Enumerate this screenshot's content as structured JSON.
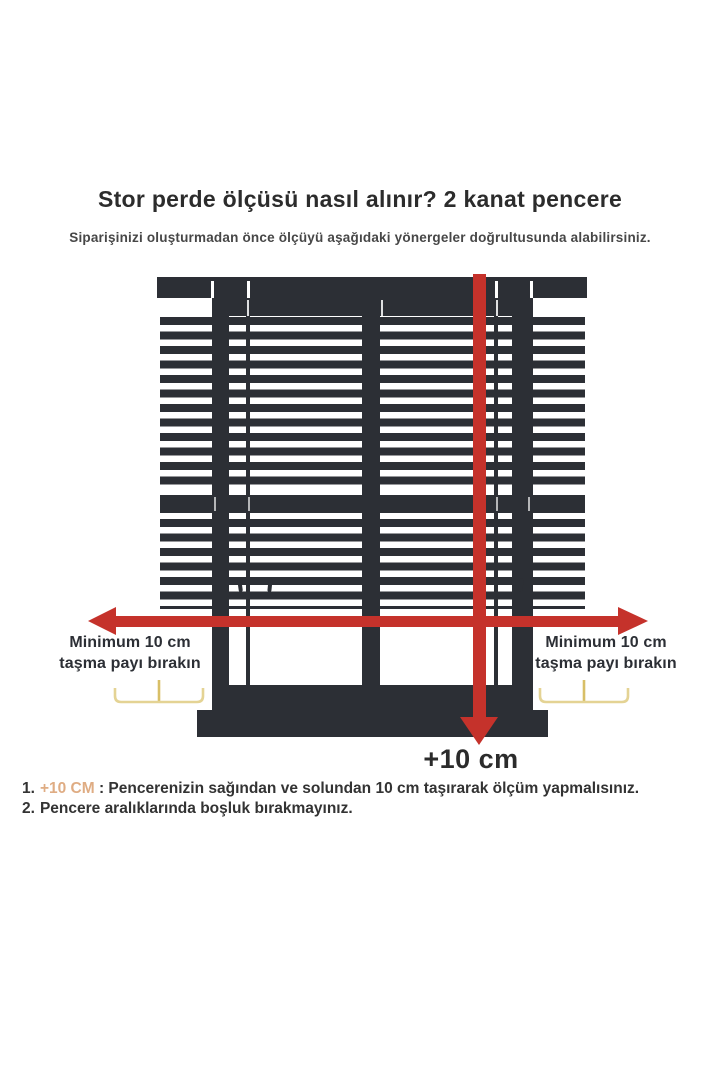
{
  "page": {
    "title": "Stor perde ölçüsü nasıl alınır? 2 kanat pencere",
    "subtitle": "Siparişinizi oluşturmadan önce ölçüyü aşağıdaki yönergeler doğrultusunda alabilirsiniz."
  },
  "diagram": {
    "left_label": {
      "line1": "Minimum 10 cm",
      "line2": "taşma payı bırakın"
    },
    "right_label": {
      "line1": "Minimum 10 cm",
      "line2": "taşma payı bırakın"
    },
    "bottom_measure_label": "+10 cm",
    "colors": {
      "blind_dark": "#2c2f35",
      "arrow_red": "#c5322b",
      "brace_yellow": "#e4d394",
      "brace_stem_yellow": "#d8bf67",
      "highlight_tan": "#dfac83"
    }
  },
  "footnotes": [
    {
      "number": "1.",
      "highlight": "+10 CM",
      "text": " : Pencerenizin sağından ve solundan 10 cm taşırarak ölçüm yapmalısınız."
    },
    {
      "number": "2.",
      "highlight": "",
      "text": "Pencere aralıklarında boşluk bırakmayınız."
    }
  ]
}
